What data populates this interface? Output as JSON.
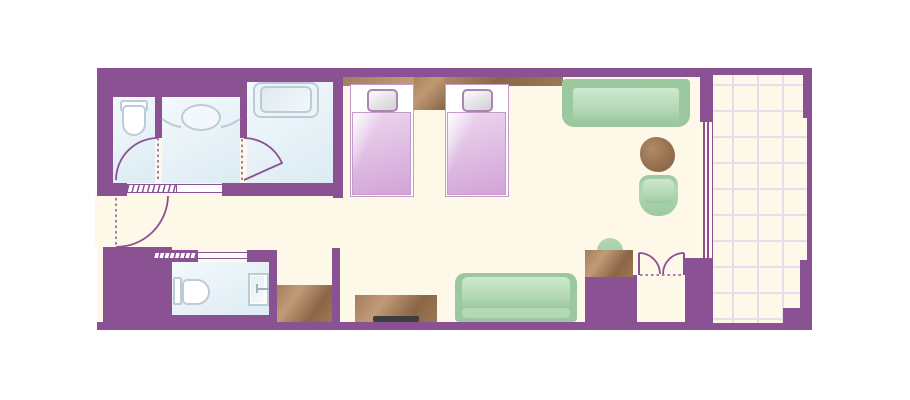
{
  "plan": {
    "kind": "hotel-room-floor-plan",
    "width_px": 910,
    "height_px": 400
  },
  "colors": {
    "wall": "#8a5292",
    "dash": "#a87bb0",
    "floor": "#fdf8e7",
    "grid": "#e6dcf0",
    "bathFloorA": "#f3f9fc",
    "bathFloorB": "#dcebf3",
    "fixtureBorder": "#bcccd7",
    "fixtureFill": "#ffffff",
    "tubFill": "#edf4f8",
    "tubInnerA": "#dfe9ef",
    "tubInnerB": "#f2f8fb",
    "woodA": "#b48d69",
    "woodB": "#7f5e41",
    "bedBorder": "#c49bcb",
    "bedCoverA": "#ecd7ee",
    "bedCoverB": "#d2a3d8",
    "pillowA": "#f5f5f7",
    "pillowB": "#d4d4d9",
    "pillowBorder": "#ab84b3",
    "greenDark": "#9cc89f",
    "greenMid": "#b2d8b4",
    "greenLight": "#cde8ce",
    "tv": "#3d3d3d"
  },
  "rooms": [
    {
      "name": "toilet-room"
    },
    {
      "name": "vanity-room"
    },
    {
      "name": "bathtub-room"
    },
    {
      "name": "entry-hall"
    },
    {
      "name": "lower-bathroom"
    },
    {
      "name": "bedroom-living-area"
    },
    {
      "name": "closet"
    },
    {
      "name": "balcony"
    }
  ],
  "furniture": [
    {
      "name": "toilet"
    },
    {
      "name": "vanity-sink"
    },
    {
      "name": "bathtub"
    },
    {
      "name": "second-toilet"
    },
    {
      "name": "shower-basin"
    },
    {
      "name": "storage-cabinet"
    },
    {
      "name": "headboard"
    },
    {
      "name": "nightstand"
    },
    {
      "name": "twin-bed-1"
    },
    {
      "name": "twin-bed-2"
    },
    {
      "name": "window-sofa"
    },
    {
      "name": "round-table"
    },
    {
      "name": "armchair"
    },
    {
      "name": "lower-sofa"
    },
    {
      "name": "tv-stand"
    },
    {
      "name": "tv"
    },
    {
      "name": "desk"
    },
    {
      "name": "desk-chair"
    },
    {
      "name": "double-door-closet"
    },
    {
      "name": "sliding-glass-door"
    }
  ]
}
